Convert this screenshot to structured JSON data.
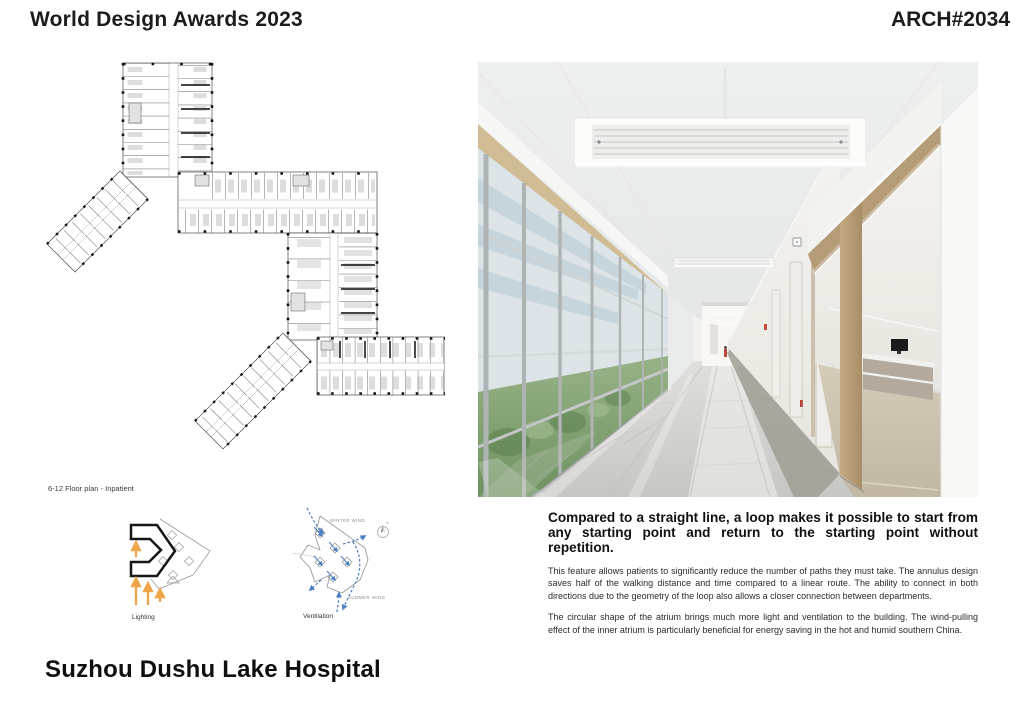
{
  "header": {
    "title": "World Design Awards 2023",
    "entry_code": "ARCH#2034"
  },
  "floor_plan": {
    "caption": "6-12 Floor plan - Inpatient"
  },
  "diagrams": {
    "lighting": {
      "label": "Lighting"
    },
    "ventilation": {
      "label": "Ventilation",
      "winter_wind_label": "WINTER WIND",
      "summer_wind_label": "SUMMER WIND",
      "compass_label": "N"
    }
  },
  "description": {
    "heading": "Compared to a straight line, a loop makes it possible to start from any starting point and return to the starting point without repetition.",
    "paragraphs": [
      "This feature allows patients to significantly reduce the number of paths they must take. The annulus design saves half of the walking distance and time compared to a linear route. The ability to connect in both directions due to the geometry of the loop also allows a closer connection between departments.",
      "The circular shape of the atrium brings much more light and ventilation to the building. The wind-pulling effect of the inner atrium is particularly beneficial for energy saving in the hot and humid southern China."
    ]
  },
  "footer": {
    "project_title": "Suzhou Dushu Lake Hospital"
  },
  "colors": {
    "sun_arrow_orange": "#F0A54A",
    "wind_blue": "#4A7FC1",
    "portal_tan": "#B59C78",
    "text_black": "#1C1C1C"
  }
}
